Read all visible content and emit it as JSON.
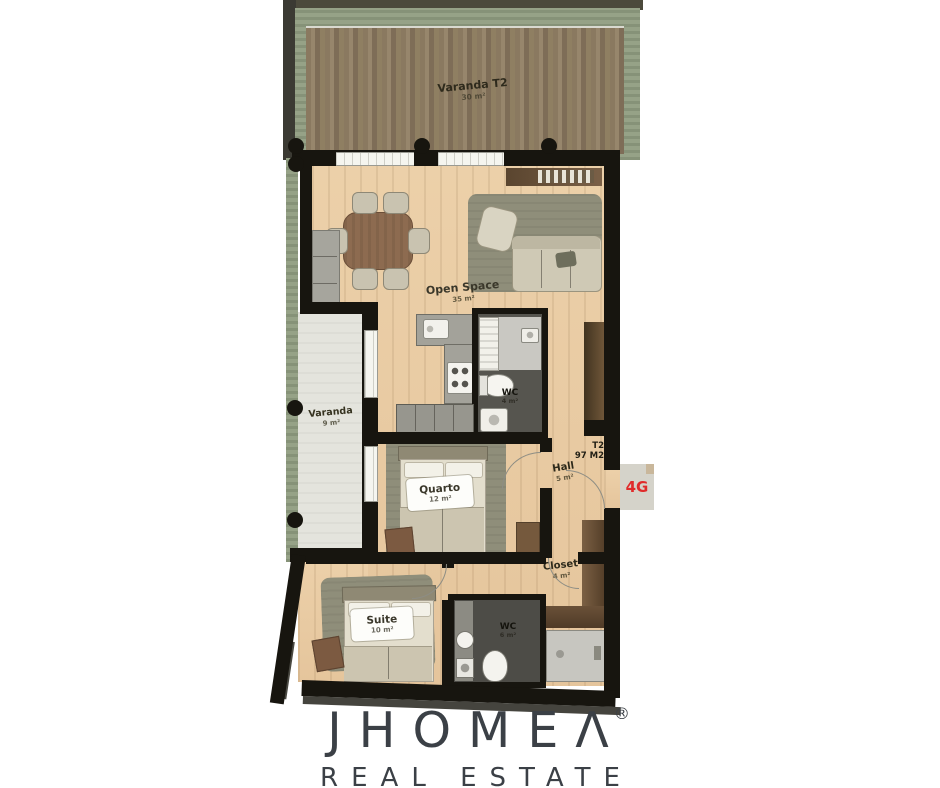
{
  "plan": {
    "unit": {
      "type": "T2",
      "area": "97 M2"
    },
    "badge_label": "4G",
    "rooms": [
      {
        "name": "Varanda T2",
        "area": "30 m²"
      },
      {
        "name": "Open Space",
        "area": "35 m²"
      },
      {
        "name": "Varanda",
        "area": "9 m²"
      },
      {
        "name": "WC",
        "area": "4 m²"
      },
      {
        "name": "Hall",
        "area": "5 m²"
      },
      {
        "name": "Quarto",
        "area": "12 m²"
      },
      {
        "name": "Closet",
        "area": "4 m²"
      },
      {
        "name": "Suite",
        "area": "10 m²"
      },
      {
        "name": "WC",
        "area": "6 m²"
      }
    ]
  },
  "branding": {
    "brand": "JHOMEΛ",
    "registered": "®",
    "tagline": "REAL ESTATE"
  },
  "palette": {
    "accent_red": "#e02b2b",
    "wall_black": "#17150f",
    "wood_floor": "#eacda5",
    "deck_brown": "#8c7a61",
    "garden_green": "#96a287",
    "logo_grey": "#3b4046"
  }
}
